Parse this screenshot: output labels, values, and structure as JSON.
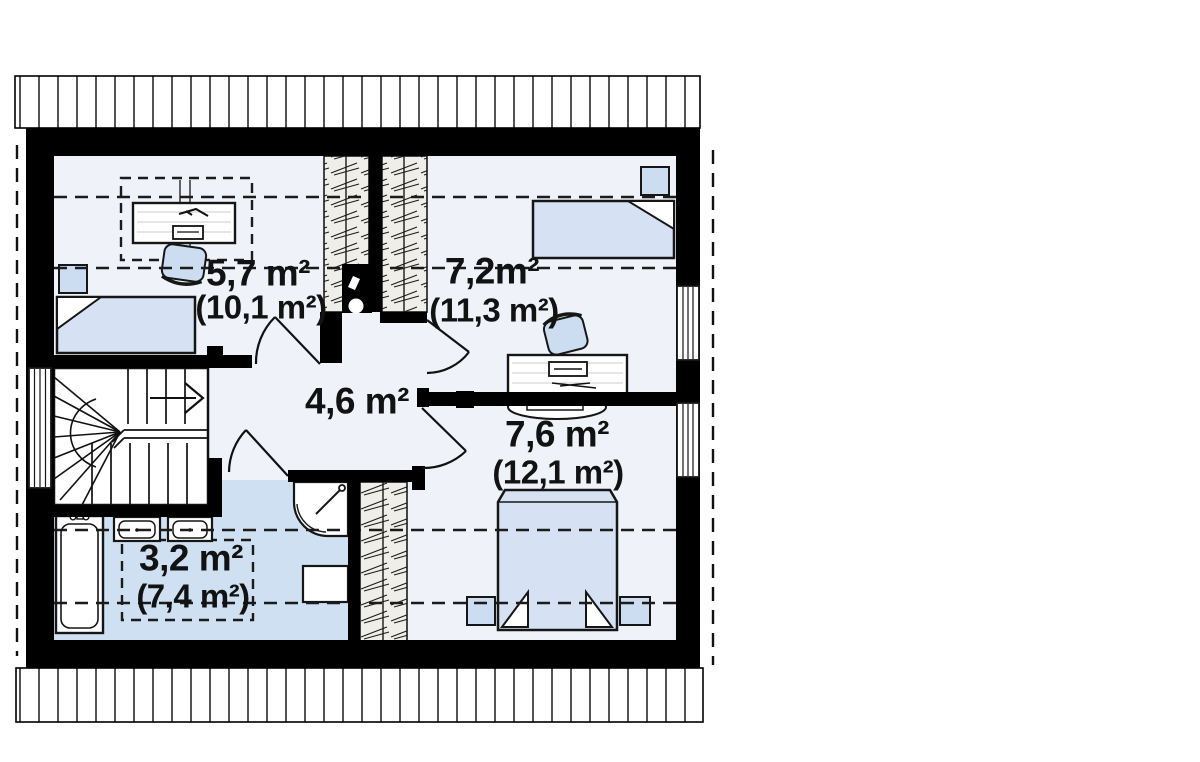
{
  "plan": {
    "kind_visible_text": "",
    "rooms": {
      "bedroom_left": {
        "area": "5,7 m²",
        "total": "(10,1 m²)"
      },
      "bedroom_right": {
        "area": "7,2m²",
        "total": "(11,3 m²)"
      },
      "hall": {
        "area": "4,6 m²"
      },
      "bathroom": {
        "area": "3,2 m²",
        "total": "(7,4 m²)"
      },
      "bedroom_master": {
        "area": "7,6 m²",
        "total": "(12,1 m²)"
      }
    },
    "colors": {
      "wall": "#000000",
      "line": "#111111",
      "floor": "#eff3f9",
      "wet_floor": "#cfe0f3",
      "furniture": "#ccddf1",
      "bed": "#d6e2f4",
      "wardrobe": "#efeee8",
      "background": "#ffffff"
    }
  }
}
